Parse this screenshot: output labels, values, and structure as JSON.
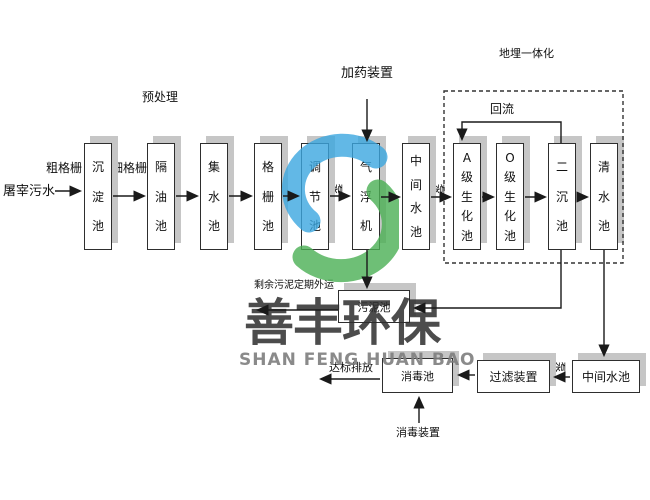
{
  "diagram": {
    "influent_label": "屠宰污水",
    "coarse_screen_label": "粗格栅",
    "fine_screen_label": "细格栅",
    "pretreatment_label": "预处理",
    "dosing_device_label": "加药装置",
    "buried_integration_label": "地埋一体化",
    "reflux_label": "回流",
    "pump_label": "泵",
    "excess_sludge_label": "剩余污泥定期外运",
    "discharge_label": "达标排放",
    "disinfect_device_label": "消毒装置"
  },
  "tanks": {
    "main_row": [
      "沉淀池",
      "隔油池",
      "集水池",
      "格栅池",
      "调节池",
      "气浮机",
      "中间水池",
      "A级生化池",
      "O级生化池",
      "二沉池",
      "清水池"
    ],
    "sludge_tank": "污泥池",
    "disinfection_tank": "消毒池",
    "filter_device": "过滤装置",
    "intermediate_tank_2": "中间水池"
  },
  "watermark": {
    "cn_text": "善丰环保",
    "en_text": "SHAN FENG HUAN BAO",
    "logo_blue": "#3ba7e0",
    "logo_green": "#4bb054"
  },
  "colors": {
    "box_border": "#2e2e2e",
    "box_shadow": "#c6c6c6",
    "line": "#1a1a1a"
  }
}
